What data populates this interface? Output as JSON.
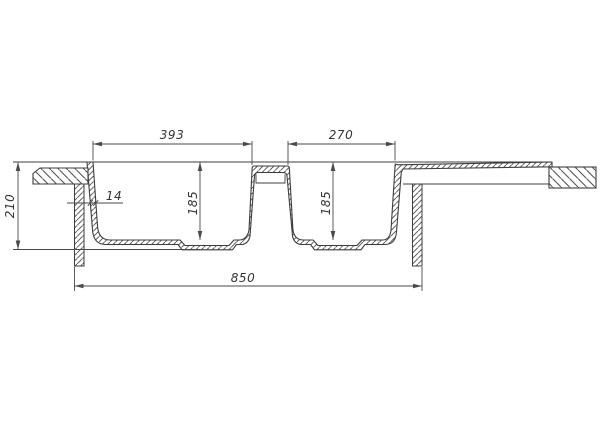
{
  "drawing": {
    "type": "technical-section-drawing",
    "subject": "double-bowl-sink-cross-section",
    "dimensions": {
      "left_bowl_width": "393",
      "right_bowl_width": "270",
      "left_bowl_depth": "185",
      "right_bowl_depth": "185",
      "overall_height": "210",
      "rim_wall_thickness": "14",
      "overall_width": "850"
    },
    "colors": {
      "background": "#ffffff",
      "object_line": "#3d3d3d",
      "dimension_line": "#4a4a4a",
      "text": "#333333"
    }
  }
}
